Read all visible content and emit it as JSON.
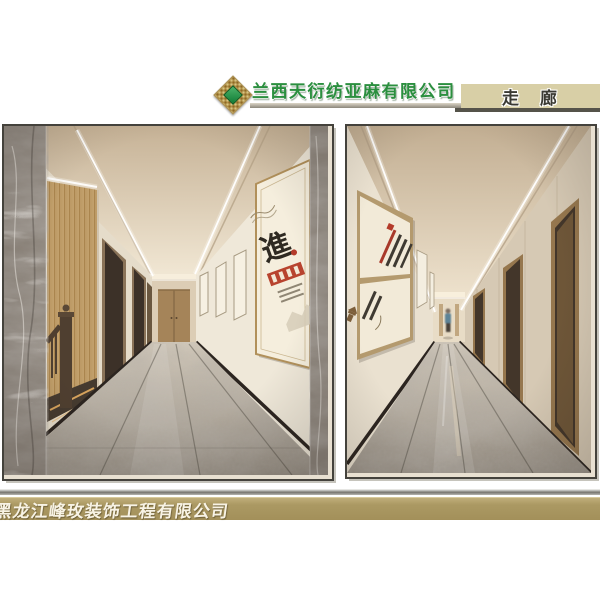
{
  "header": {
    "company_name": "兰西天衍纺亚麻有限公司",
    "tab_label": "走　廊",
    "logo_icon": "diamond-lattice-logo"
  },
  "gallery": {
    "left_view": {
      "poster_char": "進"
    },
    "right_view": {}
  },
  "footer": {
    "company_name": "黑龙江峰玫装饰工程有限公司"
  },
  "colors": {
    "title_green": "#2b8f3f",
    "logo_green": "#0f7c35",
    "tab_bg": "#d8cfa6",
    "footer_gold": "#ab9963",
    "footer_text": "#f8f3e5"
  }
}
